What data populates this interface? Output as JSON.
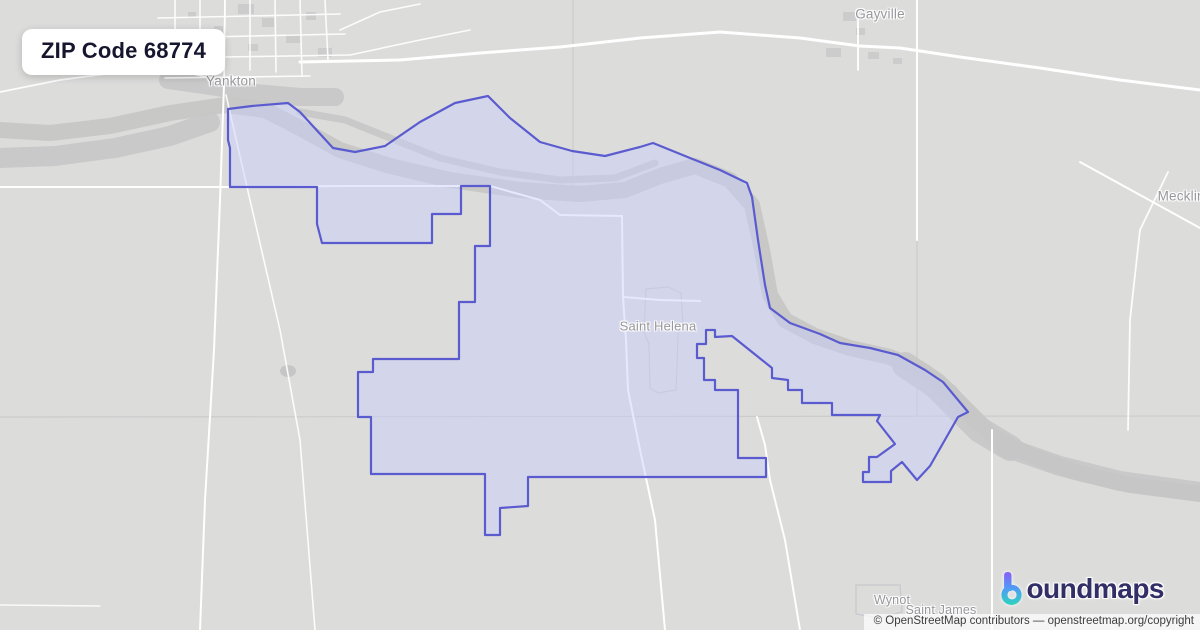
{
  "title_card": {
    "text": "ZIP Code 68774"
  },
  "attribution": {
    "text": "© OpenStreetMap contributors — openstreetmap.org/copyright"
  },
  "brand": {
    "icon": "boundmaps-b-gradient-icon",
    "wordmark_rest": "oundmaps",
    "gradient": [
      "#8b5cf6",
      "#4f9cf5",
      "#2dd4bf"
    ],
    "text_color": "#322e66"
  },
  "colors": {
    "land": "#dcdcdb",
    "river": "#c6c6c6",
    "road": "#ffffff",
    "county_line": "#cccccc",
    "building": "#c9c9c9",
    "village_outline": "#c5c5cc",
    "zone_fill": "rgba(200,207,252,0.45)",
    "zone_stroke": "#5b5bd0",
    "label": "#98989c"
  },
  "places": [
    {
      "id": "gayville",
      "label": "Gayville",
      "x": 880,
      "y": 14,
      "size": 13.5
    },
    {
      "id": "yankton",
      "label": "Yankton",
      "x": 231,
      "y": 81,
      "size": 13.5
    },
    {
      "id": "meckling",
      "label": "Meckling",
      "x": 1185,
      "y": 196,
      "size": 13.5
    },
    {
      "id": "saint-helena",
      "label": "Saint Helena",
      "x": 658,
      "y": 326,
      "size": 13
    },
    {
      "id": "wynot",
      "label": "Wynot",
      "x": 892,
      "y": 600,
      "size": 12.5
    },
    {
      "id": "saint-james",
      "label": "Saint James",
      "x": 941,
      "y": 610,
      "size": 12.5
    }
  ],
  "map": {
    "boundary": [
      [
        228,
        109
      ],
      [
        252,
        106
      ],
      [
        288,
        103
      ],
      [
        300,
        112
      ],
      [
        333,
        148
      ],
      [
        355,
        152
      ],
      [
        385,
        146
      ],
      [
        420,
        122
      ],
      [
        455,
        103
      ],
      [
        488,
        96
      ],
      [
        510,
        118
      ],
      [
        540,
        142
      ],
      [
        572,
        151
      ],
      [
        605,
        156
      ],
      [
        640,
        147
      ],
      [
        653,
        143
      ],
      [
        690,
        158
      ],
      [
        720,
        170
      ],
      [
        747,
        183
      ],
      [
        752,
        197
      ],
      [
        758,
        240
      ],
      [
        765,
        285
      ],
      [
        770,
        308
      ],
      [
        790,
        323
      ],
      [
        820,
        334
      ],
      [
        840,
        343
      ],
      [
        870,
        348
      ],
      [
        898,
        355
      ],
      [
        925,
        370
      ],
      [
        943,
        382
      ],
      [
        968,
        412
      ],
      [
        958,
        417
      ],
      [
        930,
        466
      ],
      [
        917,
        480
      ],
      [
        902,
        462
      ],
      [
        891,
        471
      ],
      [
        891,
        482
      ],
      [
        863,
        482
      ],
      [
        863,
        472
      ],
      [
        869,
        472
      ],
      [
        869,
        457
      ],
      [
        877,
        457
      ],
      [
        895,
        444
      ],
      [
        877,
        421
      ],
      [
        880,
        415
      ],
      [
        832,
        415
      ],
      [
        832,
        403
      ],
      [
        802,
        403
      ],
      [
        802,
        390
      ],
      [
        788,
        390
      ],
      [
        788,
        380
      ],
      [
        772,
        378
      ],
      [
        772,
        368
      ],
      [
        732,
        336
      ],
      [
        715,
        337
      ],
      [
        715,
        330
      ],
      [
        706,
        330
      ],
      [
        706,
        344
      ],
      [
        697,
        344
      ],
      [
        697,
        358
      ],
      [
        704,
        358
      ],
      [
        704,
        380
      ],
      [
        715,
        380
      ],
      [
        715,
        390
      ],
      [
        738,
        390
      ],
      [
        738,
        458
      ],
      [
        766,
        458
      ],
      [
        766,
        477
      ],
      [
        528,
        477
      ],
      [
        528,
        506
      ],
      [
        500,
        508
      ],
      [
        500,
        535
      ],
      [
        485,
        535
      ],
      [
        485,
        474
      ],
      [
        371,
        474
      ],
      [
        371,
        417
      ],
      [
        358,
        417
      ],
      [
        358,
        372
      ],
      [
        373,
        372
      ],
      [
        373,
        359
      ],
      [
        459,
        359
      ],
      [
        459,
        302
      ],
      [
        475,
        302
      ],
      [
        475,
        246
      ],
      [
        490,
        246
      ],
      [
        490,
        186
      ],
      [
        461,
        186
      ],
      [
        461,
        214
      ],
      [
        432,
        214
      ],
      [
        432,
        243
      ],
      [
        322,
        243
      ],
      [
        317,
        224
      ],
      [
        317,
        187
      ],
      [
        230,
        187
      ],
      [
        230,
        148
      ],
      [
        228,
        140
      ]
    ],
    "rivers": [
      {
        "w": 16,
        "o": 0.95,
        "pts": [
          [
            0,
            130
          ],
          [
            50,
            133
          ],
          [
            110,
            126
          ],
          [
            170,
            113
          ],
          [
            225,
            105
          ],
          [
            265,
            110
          ],
          [
            300,
            128
          ],
          [
            340,
            150
          ],
          [
            390,
            166
          ],
          [
            450,
            180
          ],
          [
            520,
            190
          ],
          [
            580,
            194
          ],
          [
            625,
            190
          ],
          [
            660,
            176
          ],
          [
            695,
            166
          ],
          [
            730,
            180
          ],
          [
            752,
            205
          ],
          [
            762,
            250
          ],
          [
            770,
            295
          ],
          [
            785,
            320
          ],
          [
            815,
            336
          ],
          [
            850,
            348
          ],
          [
            890,
            357
          ],
          [
            925,
            372
          ],
          [
            950,
            392
          ],
          [
            970,
            415
          ],
          [
            995,
            437
          ],
          [
            1030,
            455
          ],
          [
            1075,
            472
          ],
          [
            1130,
            485
          ],
          [
            1200,
            494
          ]
        ]
      },
      {
        "w": 26,
        "o": 0.9,
        "pts": [
          [
            905,
            365
          ],
          [
            935,
            385
          ],
          [
            958,
            408
          ],
          [
            980,
            430
          ],
          [
            1010,
            448
          ]
        ]
      },
      {
        "w": 20,
        "o": 0.9,
        "pts": [
          [
            0,
            158
          ],
          [
            55,
            156
          ],
          [
            115,
            148
          ],
          [
            170,
            136
          ],
          [
            210,
            122
          ]
        ]
      },
      {
        "w": 7,
        "o": 0.9,
        "pts": [
          [
            300,
            112
          ],
          [
            345,
            120
          ],
          [
            390,
            138
          ],
          [
            440,
            158
          ],
          [
            500,
            172
          ],
          [
            560,
            180
          ],
          [
            615,
            178
          ],
          [
            655,
            163
          ]
        ]
      },
      {
        "w": 18,
        "o": 0.85,
        "pts": [
          [
            168,
            80
          ],
          [
            210,
            86
          ],
          [
            255,
            93
          ],
          [
            300,
            97
          ],
          [
            335,
            97
          ]
        ]
      },
      {
        "w": 20,
        "o": 0.85,
        "pts": [
          [
            1005,
            447
          ],
          [
            1060,
            466
          ],
          [
            1120,
            481
          ],
          [
            1200,
            492
          ]
        ]
      }
    ],
    "county_lines": [
      [
        [
          917,
          0
        ],
        [
          917,
          415
        ]
      ],
      [
        [
          0,
          417
        ],
        [
          1200,
          416
        ]
      ],
      [
        [
          573,
          0
        ],
        [
          573,
          186
        ]
      ]
    ],
    "roads": [
      {
        "w": 3,
        "o": 1,
        "pts": [
          [
            300,
            62
          ],
          [
            400,
            60
          ],
          [
            480,
            53
          ],
          [
            560,
            47
          ],
          [
            640,
            38
          ],
          [
            720,
            32
          ],
          [
            800,
            38
          ],
          [
            860,
            46
          ],
          [
            900,
            48
          ],
          [
            960,
            57
          ],
          [
            1040,
            68
          ],
          [
            1120,
            80
          ],
          [
            1200,
            90
          ]
        ]
      },
      {
        "w": 2,
        "o": 1,
        "pts": [
          [
            0,
            187
          ],
          [
            230,
            187
          ],
          [
            350,
            186
          ],
          [
            490,
            186
          ],
          [
            540,
            200
          ],
          [
            560,
            215
          ],
          [
            622,
            216
          ]
        ]
      },
      {
        "w": 2,
        "o": 1,
        "pts": [
          [
            622,
            216
          ],
          [
            623,
            297
          ],
          [
            626,
            340
          ],
          [
            628,
            390
          ],
          [
            640,
            450
          ],
          [
            655,
            520
          ],
          [
            665,
            630
          ]
        ]
      },
      {
        "w": 2,
        "o": 1,
        "pts": [
          [
            623,
            297
          ],
          [
            660,
            300
          ],
          [
            700,
            301
          ]
        ]
      },
      {
        "w": 2,
        "o": 1,
        "pts": [
          [
            224,
            85
          ],
          [
            220,
            200
          ],
          [
            214,
            350
          ],
          [
            205,
            500
          ],
          [
            200,
            630
          ]
        ]
      },
      {
        "w": 1.6,
        "o": 0.9,
        "pts": [
          [
            226,
            95
          ],
          [
            250,
            200
          ],
          [
            280,
            330
          ],
          [
            300,
            440
          ],
          [
            315,
            630
          ]
        ]
      },
      {
        "w": 2,
        "o": 0.95,
        "pts": [
          [
            757,
            417
          ],
          [
            765,
            445
          ],
          [
            770,
            480
          ],
          [
            785,
            540
          ],
          [
            800,
            630
          ]
        ]
      },
      {
        "w": 2,
        "o": 1,
        "pts": [
          [
            917,
            0
          ],
          [
            917,
            240
          ]
        ]
      },
      {
        "w": 1.8,
        "o": 1,
        "pts": [
          [
            858,
            20
          ],
          [
            858,
            70
          ]
        ]
      },
      {
        "w": 2,
        "o": 1,
        "pts": [
          [
            992,
            430
          ],
          [
            992,
            630
          ]
        ]
      },
      {
        "w": 2,
        "o": 1,
        "pts": [
          [
            1080,
            162
          ],
          [
            1140,
            195
          ],
          [
            1200,
            228
          ]
        ]
      },
      {
        "w": 1.8,
        "o": 0.9,
        "pts": [
          [
            1168,
            172
          ],
          [
            1140,
            230
          ],
          [
            1130,
            320
          ],
          [
            1128,
            430
          ]
        ]
      },
      {
        "w": 1.8,
        "o": 0.9,
        "pts": [
          [
            0,
            92
          ],
          [
            60,
            80
          ],
          [
            120,
            72
          ],
          [
            170,
            68
          ],
          [
            210,
            78
          ],
          [
            224,
            85
          ]
        ]
      },
      {
        "w": 1.6,
        "o": 0.9,
        "pts": [
          [
            175,
            0
          ],
          [
            175,
            62
          ]
        ]
      },
      {
        "w": 1.6,
        "o": 0.9,
        "pts": [
          [
            200,
            0
          ],
          [
            200,
            68
          ]
        ]
      },
      {
        "w": 1.8,
        "o": 1,
        "pts": [
          [
            225,
            0
          ],
          [
            224,
            85
          ]
        ]
      },
      {
        "w": 1.6,
        "o": 0.9,
        "pts": [
          [
            250,
            0
          ],
          [
            250,
            70
          ]
        ]
      },
      {
        "w": 1.6,
        "o": 0.9,
        "pts": [
          [
            275,
            0
          ],
          [
            276,
            72
          ]
        ]
      },
      {
        "w": 1.6,
        "o": 0.9,
        "pts": [
          [
            300,
            0
          ],
          [
            302,
            76
          ]
        ]
      },
      {
        "w": 1.6,
        "o": 0.9,
        "pts": [
          [
            325,
            0
          ],
          [
            328,
            60
          ]
        ]
      },
      {
        "w": 1.6,
        "o": 0.9,
        "pts": [
          [
            158,
            18
          ],
          [
            340,
            14
          ]
        ]
      },
      {
        "w": 1.6,
        "o": 0.9,
        "pts": [
          [
            158,
            38
          ],
          [
            345,
            34
          ]
        ]
      },
      {
        "w": 1.6,
        "o": 0.9,
        "pts": [
          [
            160,
            58
          ],
          [
            350,
            55
          ]
        ]
      },
      {
        "w": 1.6,
        "o": 0.9,
        "pts": [
          [
            165,
            78
          ],
          [
            310,
            76
          ]
        ]
      },
      {
        "w": 1.6,
        "o": 0.9,
        "pts": [
          [
            340,
            30
          ],
          [
            380,
            12
          ],
          [
            420,
            4
          ]
        ]
      },
      {
        "w": 1.6,
        "o": 0.9,
        "pts": [
          [
            350,
            55
          ],
          [
            420,
            40
          ],
          [
            470,
            30
          ]
        ]
      },
      {
        "w": 1.6,
        "o": 0.85,
        "pts": [
          [
            0,
            605
          ],
          [
            100,
            606
          ]
        ]
      }
    ],
    "buildings": [
      [
        238,
        4,
        16,
        10
      ],
      [
        262,
        18,
        12,
        9
      ],
      [
        286,
        34,
        14,
        9
      ],
      [
        214,
        26,
        9,
        7
      ],
      [
        306,
        12,
        10,
        8
      ],
      [
        318,
        48,
        14,
        9
      ],
      [
        188,
        12,
        8,
        6
      ],
      [
        248,
        44,
        10,
        7
      ],
      [
        843,
        12,
        13,
        9
      ],
      [
        826,
        48,
        15,
        9
      ],
      [
        856,
        28,
        9,
        7
      ],
      [
        868,
        52,
        11,
        7
      ],
      [
        893,
        58,
        9,
        6
      ]
    ],
    "ponds": [
      {
        "cx": 288,
        "cy": 371,
        "rx": 8,
        "ry": 6
      }
    ],
    "village_outlines": [
      {
        "pts": [
          [
            646,
            289
          ],
          [
            668,
            287
          ],
          [
            681,
            293
          ],
          [
            683,
            326
          ],
          [
            678,
            334
          ],
          [
            677,
            368
          ],
          [
            676,
            390
          ],
          [
            658,
            393
          ],
          [
            650,
            388
          ],
          [
            649,
            344
          ],
          [
            644,
            332
          ]
        ]
      },
      {
        "pts": [
          [
            856,
            585
          ],
          [
            900,
            585
          ],
          [
            902,
            612
          ],
          [
            880,
            618
          ],
          [
            856,
            614
          ]
        ]
      }
    ]
  }
}
